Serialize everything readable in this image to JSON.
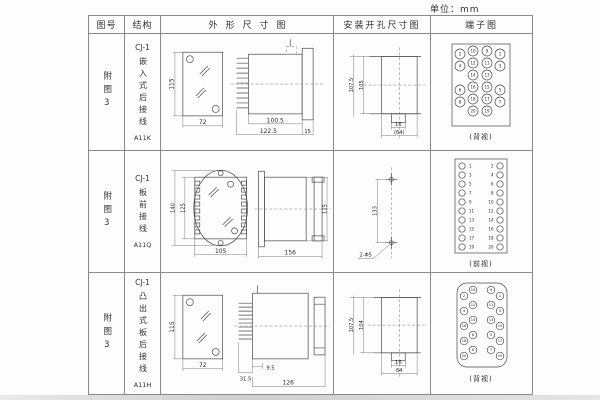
{
  "unit_label": "单位：mm",
  "table": {
    "headers": [
      "图号",
      "结构",
      "外形尺寸图",
      "安装开孔尺寸图",
      "端子图"
    ],
    "rows": [
      {
        "figure_no": "附图3",
        "structure": {
          "model": "CJ-1",
          "type": "嵌入式后接线",
          "code": "A11K"
        },
        "outline": {
          "front_height": "115",
          "front_width": "72",
          "body_depth": "100.5",
          "total_depth": "122.5",
          "flange_width": "15"
        },
        "install": {
          "outer_height": "107.5",
          "inner_height": "105",
          "slot_width": "16",
          "hole_span": "(64)"
        },
        "terminal": {
          "caption": "(背视)",
          "numbers": [
            "2",
            "10",
            "9",
            "1",
            "4",
            "12",
            "11",
            "3",
            "14",
            "13",
            "6",
            "16",
            "15",
            "5",
            "8",
            "18",
            "17",
            "7",
            "20",
            "19"
          ]
        }
      },
      {
        "figure_no": "附图3",
        "structure": {
          "model": "CJ-1",
          "type": "板前接线",
          "code": "A11Q"
        },
        "outline": {
          "front_outer_height": "140",
          "front_inner_height": "125",
          "front_width": "105",
          "side_depth": "156",
          "side_height": "115"
        },
        "install": {
          "hole_spacing": "133",
          "hole_label": "2-Φ5"
        },
        "terminal": {
          "caption": "(前视)",
          "left": [
            "1",
            "3",
            "5",
            "7",
            "9",
            "11",
            "13",
            "15",
            "17",
            "19"
          ],
          "right": [
            "2",
            "4",
            "6",
            "8",
            "10",
            "12",
            "14",
            "16",
            "18",
            "20"
          ]
        }
      },
      {
        "figure_no": "附图3",
        "structure": {
          "model": "CJ-1",
          "type": "凸出式板后接线",
          "code": "A11H"
        },
        "outline": {
          "front_height": "115",
          "front_width": "72",
          "pin_depth": "31.5",
          "step_depth": "9.5",
          "body_depth": "126"
        },
        "install": {
          "outer_height": "107.5",
          "inner_height": "104",
          "slot_width": "16",
          "hole_span": "64"
        },
        "terminal": {
          "caption": "(背视)",
          "left": [
            "10",
            "2",
            "12",
            "4",
            "14",
            "16",
            "6",
            "18",
            "8",
            "20"
          ],
          "right": [
            "9",
            "1",
            "11",
            "3",
            "13",
            "15",
            "5",
            "17",
            "7",
            "19"
          ]
        }
      }
    ]
  }
}
